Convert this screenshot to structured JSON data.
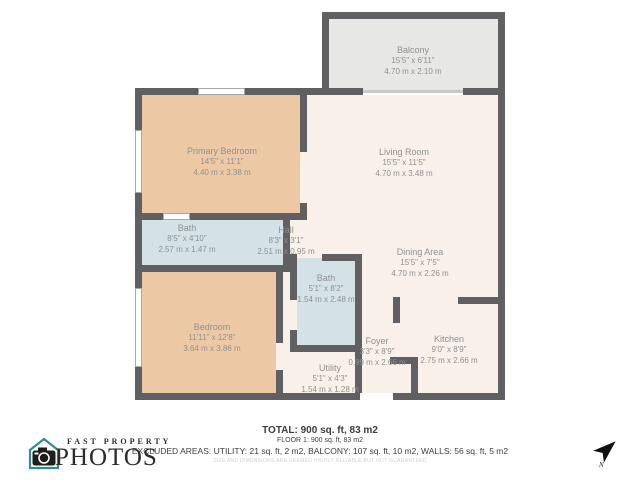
{
  "palette": {
    "wall": "#606062",
    "room_warm": "#ecc9a4",
    "room_neutral": "#f8f0e9",
    "room_wet": "#d4e2e7",
    "balcony": "#e7e7e5",
    "label_text": "#909090",
    "logo_teal": "#2e8f8a"
  },
  "rooms": [
    {
      "id": "balcony",
      "name": "Balcony",
      "dims_imperial": "15'5\" x 6'11\"",
      "dims_metric": "4.70 m x 2.10 m"
    },
    {
      "id": "primary-bedroom",
      "name": "Primary Bedroom",
      "dims_imperial": "14'5\" x 11'1\"",
      "dims_metric": "4.40 m x 3.38 m"
    },
    {
      "id": "living-room",
      "name": "Living Room",
      "dims_imperial": "15'5\" x 11'5\"",
      "dims_metric": "4.70 m x 3.48 m"
    },
    {
      "id": "bath",
      "name": "Bath",
      "dims_imperial": "8'5\" x 4'10\"",
      "dims_metric": "2.57 m x 1.47 m"
    },
    {
      "id": "hall",
      "name": "Hall",
      "dims_imperial": "8'3\" x 3'1\"",
      "dims_metric": "2.51 m x 0.95 m"
    },
    {
      "id": "dining-area",
      "name": "Dining Area",
      "dims_imperial": "15'5\" x 7'5\"",
      "dims_metric": "4.70 m x 2.26 m"
    },
    {
      "id": "bath-2",
      "name": "Bath",
      "dims_imperial": "5'1\" x 8'2\"",
      "dims_metric": "1.54 m x 2.48 m"
    },
    {
      "id": "bedroom",
      "name": "Bedroom",
      "dims_imperial": "11'11\" x 12'8\"",
      "dims_metric": "3.64 m x 3.86 m"
    },
    {
      "id": "foyer",
      "name": "Foyer",
      "dims_imperial": "3'3\" x 8'9\"",
      "dims_metric": "0.99 m x 2.66 m"
    },
    {
      "id": "kitchen",
      "name": "Kitchen",
      "dims_imperial": "9'0\" x 8'9\"",
      "dims_metric": "2.75 m x 2.66 m"
    },
    {
      "id": "utility",
      "name": "Utility",
      "dims_imperial": "5'1\" x 4'3\"",
      "dims_metric": "1.54 m x 1.28 m"
    }
  ],
  "footer": {
    "total": "TOTAL: 900 sq. ft, 83 m2",
    "floor": "FLOOR 1: 900 sq. ft, 83 m2",
    "excluded": "EXCLUDED AREAS: UTILITY: 21 sq. ft, 2 m2, BALCONY: 107 sq. ft, 10 m2, WALLS: 56 sq. ft, 5 m2",
    "disclaimer": "SIZE AND DIMENSIONS ARE DEEMED HIGHLY RELIABLE BUT NOT GUARANTEED"
  },
  "logo": {
    "top": "FAST PROPERTY",
    "bottom": "PHOTOS"
  },
  "compass": {
    "label": "N"
  }
}
